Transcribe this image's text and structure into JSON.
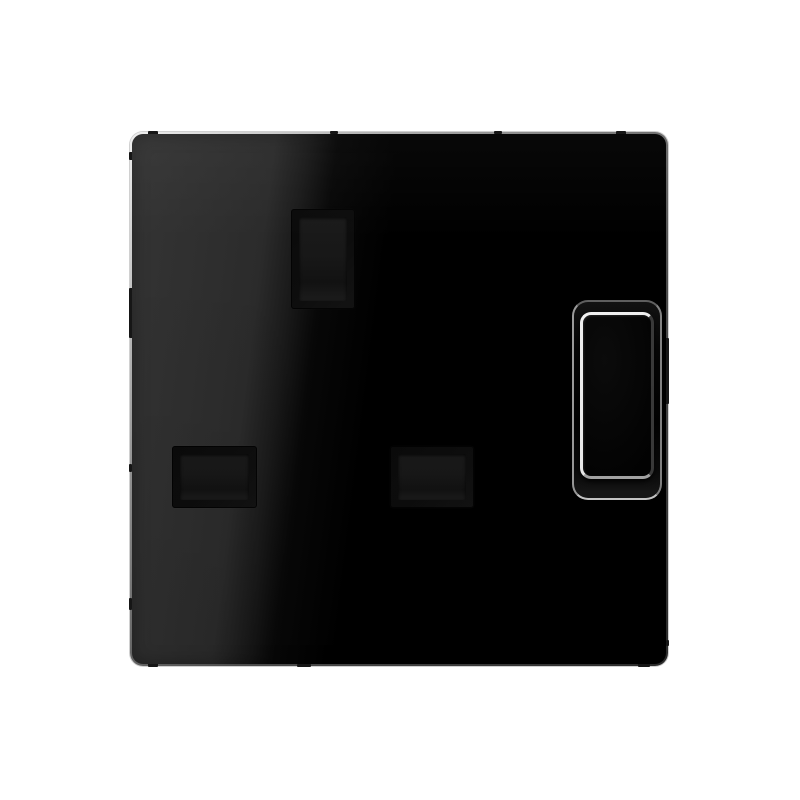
{
  "scene": {
    "type": "product-photo",
    "subject": "black glossy UK switched socket faceplate (BS 1363 style), single gang, on plain white background",
    "text_visible": "none"
  },
  "colors": {
    "bg": "#ffffff",
    "plate-lit": "#2f2f2f",
    "plate-black": "#000000",
    "rim-light": "#d6d6d6",
    "rim-dark": "#2a2a2a",
    "aperture-frame": "#0d0d0d",
    "aperture-inner": "#181818",
    "well-outline-bright": "#cccccc",
    "well-outline-dim": "#606060",
    "rocker-highlight": "#f2f2f2",
    "rocker-shadow-edge": "#3a3a3a",
    "rocker-bottom-edge": "#a8a8a8",
    "notch": "#161616"
  },
  "faceplate": {
    "finish": "high-gloss",
    "sheen": "diagonal reflection: lit dark-grey on left third, deep black on right",
    "corner_style": "rounded"
  },
  "apertures": {
    "earth": {
      "orientation": "vertical",
      "position": "top center-left"
    },
    "live": {
      "orientation": "horizontal",
      "position": "bottom left"
    },
    "neutral": {
      "orientation": "horizontal",
      "position": "bottom center"
    }
  },
  "switch": {
    "kind": "rocker",
    "state": "off",
    "position": "right side, vertically centered",
    "highlight": "bright white rim light on top/left edges of rocker"
  }
}
